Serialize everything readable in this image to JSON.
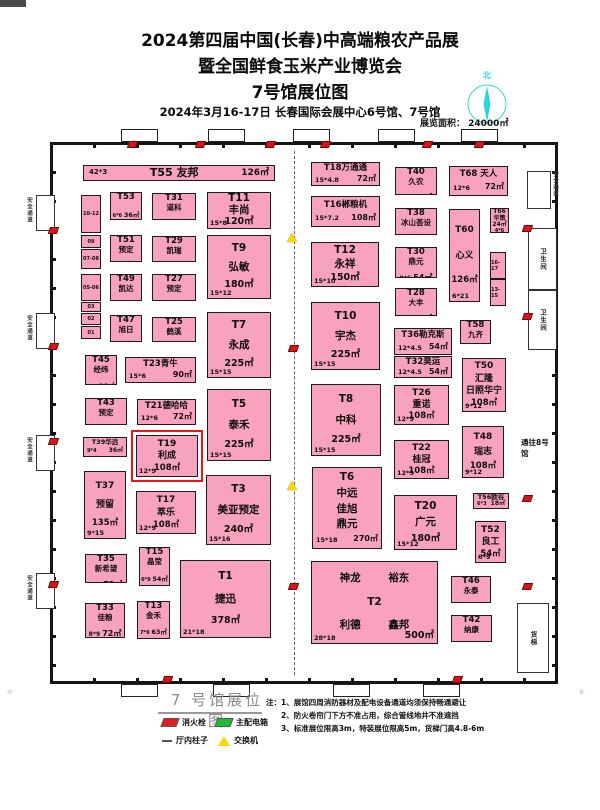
{
  "header": {
    "line1": "2024第四届中国(长春)中高端粮农产品展",
    "line2": "暨全国鲜食玉米产业博览会",
    "line3": "7号馆展位图",
    "line4": "2024年3月16-17日  长春国际会展中心6号馆、7号馆",
    "area_label": "展览面积： 24000㎡",
    "compass_north": "北"
  },
  "hall": {
    "booths": [
      {
        "id": "T55",
        "name": " 友邦",
        "dims": "42*3",
        "area": "126㎡",
        "x": 30,
        "y": 20,
        "w": 192,
        "h": 16,
        "type": "bar",
        "size": "sm"
      },
      {
        "id": "T53",
        "name": null,
        "dims": "6*6",
        "area": "36㎡",
        "x": 57,
        "y": 47,
        "w": 32,
        "h": 28,
        "type": "compact",
        "size": "sm"
      },
      {
        "id": "T51",
        "name": "预定",
        "dims": "6*6",
        "area": "36㎡",
        "x": 57,
        "y": 90,
        "w": 32,
        "h": 27,
        "type": "compact",
        "size": "sm"
      },
      {
        "id": "T49",
        "name": "凯达",
        "dims": "6*6",
        "area": "36㎡",
        "x": 57,
        "y": 129,
        "w": 32,
        "h": 27,
        "type": "compact",
        "size": "sm"
      },
      {
        "id": "T47",
        "name": "旭日",
        "dims": "6*6",
        "area": "36㎡",
        "x": 57,
        "y": 170,
        "w": 32,
        "h": 27,
        "type": "compact",
        "size": "sm"
      },
      {
        "id": "T45",
        "name": "经纬",
        "dims": "6*6",
        "area": "36㎡",
        "x": 32,
        "y": 210,
        "w": 32,
        "h": 30,
        "type": "compact",
        "size": "sm"
      },
      {
        "id": "T43",
        "name": "预定",
        "dims": "9*6",
        "area": "54㎡",
        "x": 32,
        "y": 253,
        "w": 42,
        "h": 27,
        "type": "compact",
        "size": "sm"
      },
      {
        "id": "T39",
        "name": "华远",
        "dims": "9*4",
        "area": "36㎡",
        "x": 30,
        "y": 292,
        "w": 44,
        "h": 20,
        "type": "inline",
        "size": "xs"
      },
      {
        "id": "T37",
        "name": "预留",
        "dims": "9*15",
        "area": "135㎡",
        "x": 31,
        "y": 326,
        "w": 42,
        "h": 68,
        "type": "stack",
        "size": "md"
      },
      {
        "id": "T35",
        "name": "新希望",
        "dims": "9*8",
        "area": "72㎡",
        "x": 32,
        "y": 409,
        "w": 42,
        "h": 29,
        "type": "compact",
        "size": "sm"
      },
      {
        "id": "T33",
        "name": "佳粮",
        "dims": "8*9",
        "area": "72㎡",
        "x": 32,
        "y": 458,
        "w": 40,
        "h": 35,
        "type": "compact",
        "size": "sm"
      },
      {
        "id": "T31",
        "name": "道科",
        "dims": "9*6",
        "area": "54㎡",
        "x": 99,
        "y": 48,
        "w": 44,
        "h": 27,
        "type": "compact",
        "size": "sm"
      },
      {
        "id": "T29",
        "name": "凯瑞",
        "dims": "9*6",
        "area": "54㎡",
        "x": 99,
        "y": 91,
        "w": 44,
        "h": 26,
        "type": "compact",
        "size": "sm"
      },
      {
        "id": "T27",
        "name": "预定",
        "dims": "9*6",
        "area": "54㎡",
        "x": 99,
        "y": 129,
        "w": 44,
        "h": 27,
        "type": "compact",
        "size": "sm"
      },
      {
        "id": "T25",
        "name": "鹤溪",
        "dims": "9*6",
        "area": "54㎡",
        "x": 99,
        "y": 172,
        "w": 44,
        "h": 25,
        "type": "compact",
        "size": "sm"
      },
      {
        "id": "T23",
        "name": "青牛",
        "dims": "15*6",
        "area": "90㎡",
        "x": 72,
        "y": 212,
        "w": 71,
        "h": 26,
        "type": "inline",
        "size": "sm"
      },
      {
        "id": "T21",
        "name": "德哈哈",
        "dims": "12*6",
        "area": "72㎡",
        "x": 84,
        "y": 254,
        "w": 59,
        "h": 26,
        "type": "inline",
        "size": "sm"
      },
      {
        "id": "T19",
        "name": "利成",
        "dims": "12*9",
        "area": "108㎡",
        "x": 83,
        "y": 290,
        "w": 62,
        "h": 42,
        "type": "stack",
        "size": "md",
        "hl": true
      },
      {
        "id": "T17",
        "name": "萃乐",
        "dims": "12*9",
        "area": "108㎡",
        "x": 83,
        "y": 346,
        "w": 60,
        "h": 43,
        "type": "stack",
        "size": "md"
      },
      {
        "id": "T15",
        "name": "晶莹",
        "dims": "6*9",
        "area": "54㎡",
        "x": 86,
        "y": 402,
        "w": 31,
        "h": 39,
        "type": "compact",
        "size": "sm"
      },
      {
        "id": "T13",
        "name": "金禾",
        "dims": "7*9",
        "area": "63㎡",
        "x": 84,
        "y": 456,
        "w": 33,
        "h": 38,
        "type": "compact",
        "size": "sm"
      },
      {
        "id": "T11",
        "name": "丰尚",
        "dims": "15*8",
        "area": "120㎡",
        "x": 154,
        "y": 47,
        "w": 64,
        "h": 37,
        "type": "stack",
        "size": "lg"
      },
      {
        "id": "T9",
        "name": "弘敏",
        "dims": "15*12",
        "area": "180㎡",
        "x": 154,
        "y": 90,
        "w": 64,
        "h": 64,
        "type": "stack",
        "size": "lg"
      },
      {
        "id": "T7",
        "name": "永成",
        "dims": "15*15",
        "area": "225㎡",
        "x": 154,
        "y": 167,
        "w": 64,
        "h": 66,
        "type": "stack",
        "size": "lg"
      },
      {
        "id": "T5",
        "name": "泰禾",
        "dims": "15*15",
        "area": "225㎡",
        "x": 154,
        "y": 244,
        "w": 64,
        "h": 72,
        "type": "stack",
        "size": "lg"
      },
      {
        "id": "T3",
        "name": "美亚预定",
        "dims": "15*16",
        "area": "240㎡",
        "x": 153,
        "y": 330,
        "w": 65,
        "h": 70,
        "type": "stack",
        "size": "lg"
      },
      {
        "id": "T1",
        "name": "捷迅",
        "dims": "21*18",
        "area": "378㎡",
        "x": 127,
        "y": 415,
        "w": 91,
        "h": 78,
        "type": "stack",
        "size": "lg"
      },
      {
        "id": "T18",
        "name": "万通通",
        "dims": "15*4.8",
        "area": "72㎡",
        "x": 258,
        "y": 17,
        "w": 69,
        "h": 24,
        "type": "inline",
        "size": "sm"
      },
      {
        "id": "T16",
        "name": "郴粮机",
        "dims": "15*7.2",
        "area": "108㎡",
        "x": 258,
        "y": 51,
        "w": 69,
        "h": 31,
        "type": "inline",
        "size": "sm"
      },
      {
        "id": "T12",
        "name": "永祥",
        "dims": "15*10",
        "area": "150㎡",
        "x": 258,
        "y": 97,
        "w": 68,
        "h": 45,
        "type": "stack",
        "size": "lg"
      },
      {
        "id": "T10",
        "name": "宇杰",
        "dims": "15*15",
        "area": "225㎡",
        "x": 258,
        "y": 157,
        "w": 69,
        "h": 68,
        "type": "stack",
        "size": "lg"
      },
      {
        "id": "T8",
        "name": "中科",
        "dims": "15*15",
        "area": "225㎡",
        "x": 258,
        "y": 239,
        "w": 70,
        "h": 72,
        "type": "stack",
        "size": "lg"
      },
      {
        "id": "T6",
        "names": [
          "中远",
          "佳旭",
          "鼎元"
        ],
        "dims": "15*18",
        "area": "270㎡",
        "x": 259,
        "y": 322,
        "w": 70,
        "h": 82,
        "type": "t6",
        "size": "lg"
      },
      {
        "id": "T2",
        "names": [
          "神龙",
          "裕东",
          "利德",
          "鑫邦"
        ],
        "dims": "28*18",
        "area": "500㎡",
        "x": 258,
        "y": 416,
        "w": 127,
        "h": 83,
        "type": "t2",
        "size": "lg"
      },
      {
        "id": "T40",
        "name": "久农",
        "dims": "9*6",
        "area": "54㎡",
        "x": 342,
        "y": 22,
        "w": 42,
        "h": 28,
        "type": "compact",
        "size": "sm"
      },
      {
        "id": "T38",
        "name": "冰山荟设",
        "dims": "9*6",
        "area": "54㎡",
        "x": 342,
        "y": 63,
        "w": 42,
        "h": 27,
        "type": "compact",
        "size": "sm"
      },
      {
        "id": "T30",
        "name": "鼎元",
        "dims": "9*6",
        "area": "54㎡",
        "x": 342,
        "y": 102,
        "w": 42,
        "h": 31,
        "type": "compact",
        "size": "sm"
      },
      {
        "id": "T28",
        "name": "大丰",
        "dims": "9*6",
        "area": "54㎡",
        "x": 342,
        "y": 143,
        "w": 42,
        "h": 28,
        "type": "compact",
        "size": "sm"
      },
      {
        "id": "T36",
        "name": "勒克斯",
        "dims": "12*4.5",
        "area": "54㎡",
        "x": 341,
        "y": 183,
        "w": 58,
        "h": 27,
        "type": "inline",
        "size": "sm"
      },
      {
        "id": "T32",
        "name": "昊运",
        "dims": "12*4.5",
        "area": "54㎡",
        "x": 341,
        "y": 211,
        "w": 58,
        "h": 22,
        "type": "inline",
        "size": "sm"
      },
      {
        "id": "T26",
        "name": "重诺",
        "dims": "12*9",
        "area": "108㎡",
        "x": 341,
        "y": 240,
        "w": 55,
        "h": 40,
        "type": "stack",
        "size": "md"
      },
      {
        "id": "T22",
        "name": "桂冠",
        "dims": "12*9",
        "area": "108㎡",
        "x": 341,
        "y": 295,
        "w": 55,
        "h": 39,
        "type": "stack",
        "size": "md"
      },
      {
        "id": "T20",
        "name": "广元",
        "dims": "15*12",
        "area": "180㎡",
        "x": 341,
        "y": 350,
        "w": 63,
        "h": 55,
        "type": "stack",
        "size": "lg"
      },
      {
        "id": "T68",
        "name": " 天人",
        "dims": "12*6",
        "area": "72㎡",
        "x": 396,
        "y": 21,
        "w": 59,
        "h": 30,
        "type": "inline",
        "size": "sm"
      },
      {
        "id": "T66",
        "name": "华策",
        "dims": "4*6",
        "area": "24㎡",
        "x": 437,
        "y": 63,
        "w": 19,
        "h": 25,
        "type": "tiny",
        "size": "xs"
      },
      {
        "id": "T60",
        "name": "心义",
        "dims": "6*21",
        "area": "126㎡",
        "x": 396,
        "y": 64,
        "w": 31,
        "h": 93,
        "type": "stack",
        "size": "md"
      },
      {
        "id": "T58",
        "name": "九齐",
        "dims": "6*6",
        "area": "36㎡",
        "x": 407,
        "y": 175,
        "w": 31,
        "h": 24,
        "type": "compact",
        "size": "sm"
      },
      {
        "id": "T50",
        "names": [
          "汇隆",
          "日照华宁"
        ],
        "dims": "9*12",
        "area": "108㎡",
        "x": 409,
        "y": 213,
        "w": 44,
        "h": 54,
        "type": "stack",
        "size": "md"
      },
      {
        "id": "T48",
        "name": "瑞志",
        "dims": "9*12",
        "area": "108㎡",
        "x": 409,
        "y": 281,
        "w": 42,
        "h": 52,
        "type": "stack",
        "size": "md"
      },
      {
        "id": "T56",
        "name": "欧谷",
        "dims": "6*3",
        "area": "18㎡",
        "x": 420,
        "y": 348,
        "w": 36,
        "h": 16,
        "type": "inline",
        "size": "xs"
      },
      {
        "id": "T52",
        "name": "良工",
        "dims": "6*9",
        "area": "54㎡",
        "x": 422,
        "y": 376,
        "w": 31,
        "h": 42,
        "type": "stack",
        "size": "md"
      },
      {
        "id": "T46",
        "name": "永泰",
        "dims": "9*6",
        "area": "54㎡",
        "x": 398,
        "y": 431,
        "w": 40,
        "h": 27,
        "type": "compact",
        "size": "sm"
      },
      {
        "id": "T42",
        "name": "纳康",
        "dims": "9*6",
        "area": "54㎡",
        "x": 398,
        "y": 470,
        "w": 41,
        "h": 27,
        "type": "compact",
        "size": "sm"
      }
    ],
    "west_strip": [
      {
        "label": "10-12",
        "y": 50,
        "h": 38
      },
      {
        "label": "09",
        "y": 90,
        "h": 13
      },
      {
        "label": "07-08",
        "y": 104,
        "h": 20
      },
      {
        "label": "05-06",
        "y": 129,
        "h": 27
      },
      {
        "label": "03",
        "y": 157,
        "h": 10
      },
      {
        "label": "02",
        "y": 168,
        "h": 12
      },
      {
        "label": "01",
        "y": 181,
        "h": 13
      }
    ],
    "east_strip": [
      {
        "label": "16-17",
        "y": 107,
        "h": 27
      },
      {
        "label": "13-15",
        "y": 134,
        "h": 27
      }
    ],
    "left_doors": {
      "label": "安全通道",
      "ys": [
        50,
        168,
        290,
        428
      ]
    },
    "right_door": {
      "label": "安全通道",
      "x": 474,
      "y": 26,
      "w": 22,
      "h": 36
    },
    "rooms": [
      {
        "label": "卫生间",
        "x": 475,
        "y": 83,
        "w": 27,
        "h": 60
      },
      {
        "label": "卫生间",
        "x": 475,
        "y": 145,
        "w": 27,
        "h": 58
      },
      {
        "label": "货梯",
        "x": 464,
        "y": 458,
        "w": 30,
        "h": 68
      }
    ],
    "corridor_label": "通往8号馆",
    "markers": {
      "hydrants": [
        [
          75,
          -4
        ],
        [
          143,
          -4
        ],
        [
          213,
          -4
        ],
        [
          268,
          -4
        ],
        [
          370,
          -4
        ],
        [
          422,
          -4
        ],
        [
          110,
          531
        ],
        [
          400,
          531
        ],
        [
          -4,
          82
        ],
        [
          -4,
          198
        ],
        [
          -4,
          293
        ],
        [
          -4,
          436
        ],
        [
          470,
          80
        ],
        [
          470,
          168
        ],
        [
          470,
          350
        ],
        [
          470,
          438
        ],
        [
          236,
          200
        ],
        [
          236,
          438
        ]
      ],
      "switches": [
        [
          234,
          88
        ],
        [
          234,
          336
        ]
      ]
    }
  },
  "footer": {
    "title": "7 号馆展位图",
    "legend": [
      {
        "type": "hydrant",
        "label": "消火栓"
      },
      {
        "type": "power",
        "label": "主配电箱"
      },
      {
        "type": "pillar",
        "label": "厅内柱子"
      },
      {
        "type": "switch",
        "label": "交换机"
      }
    ],
    "notes_label": "注：",
    "notes": [
      "1、展馆四周消防器材及配电设备通道均须保持畅通避让",
      "2、防火卷帘门下方不准占用，综合管线地井不准遮挡",
      "3、标准展位限高3m，特装展位限高5m，货梯门高4.8-6m"
    ]
  }
}
